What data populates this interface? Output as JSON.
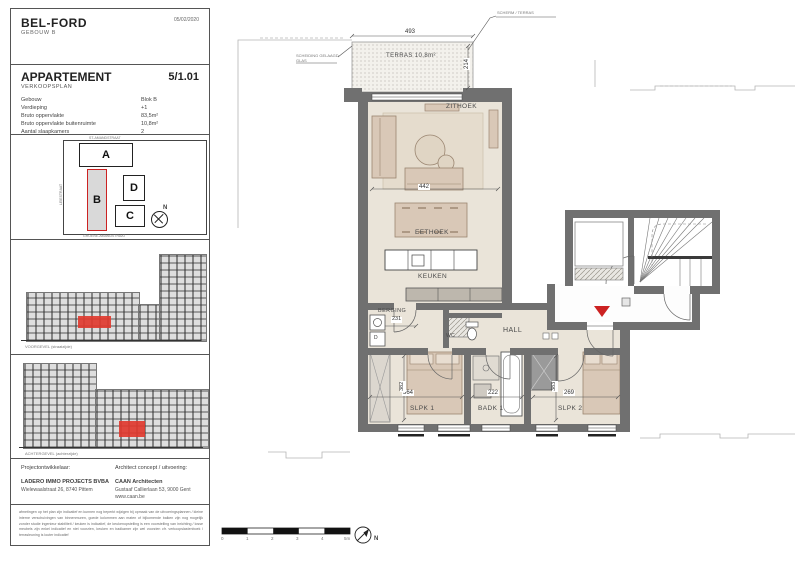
{
  "header": {
    "title": "BEL-FORD",
    "subtitle": "GEBOUW B",
    "date": "05/02/2020"
  },
  "apartment": {
    "label": "APPARTEMENT",
    "number": "5/1.01",
    "plan_type": "VERKOOPSPLAN",
    "specs": [
      {
        "label": "Gebouw",
        "value": "Blok B"
      },
      {
        "label": "Verdieping",
        "value": "+1"
      },
      {
        "label": "Bruto oppervlakte",
        "value": "83,5m²"
      },
      {
        "label": "Bruto oppervlakte buitenruimte",
        "value": "10,8m²"
      },
      {
        "label": "Aantal slaapkamers",
        "value": "2"
      },
      {
        "label": "plafondhoogte",
        "value": "+/-2,50m"
      }
    ]
  },
  "siteplan": {
    "blocks": [
      "A",
      "B",
      "C",
      "D"
    ],
    "street_top": "ST-AMANDSTRAAT",
    "street_left": "LEIESTRAAT",
    "street_bottom": "GROENE-AMANDSTRAAT",
    "north_label": "N"
  },
  "elevations": [
    {
      "caption": "VOORGEVEL (straatzijde)"
    },
    {
      "caption": "ACHTERGEVEL (achterzijde)"
    }
  ],
  "project": {
    "developer_label": "Projectontwikkelaar:",
    "developer_name": "LADERO IMMO PROJECTS BVBA",
    "developer_address": "Wielewaalstraat 26, 8740 Pittem",
    "architect_label": "Architect concept / uitvoering:",
    "architect_name": "CAAN Architecten",
    "architect_address": "Gustaaf Callierlaan 53, 9000 Gent",
    "architect_web": "www.caan.be"
  },
  "disclaimer": "afmetingen op het plan zijn indicatief en kunnen nog beperkt wijzigen bij opmaak van de uitvoeringsplannen / kleine interne verschuivingen van binnenmuren, goede kolommen aan maten of bijkomende balken zijn nog mogelijk zonder studie ingenieur stabiliteit / keuken is indicatief, de keukenopstelling is een voorstelling van inrichting / losse meubels zijn enkel indicatief en niet voorzien, keuken en badkamer zijn wel voorzien cfr. verkoopslastenboek / terrasleuning is louter indicatief",
  "plan": {
    "rooms": {
      "terras": "TERRAS 10,8m²",
      "zithoek": "ZITHOEK",
      "eethoek": "EETHOEK",
      "keuken": "KEUKEN",
      "berging": "BERGING",
      "wc": "WC",
      "hall": "HALL",
      "slpk1": "SLPK 1",
      "badk1": "BADK 1",
      "slpk2": "SLPK 2"
    },
    "dims": {
      "terras_w": "493",
      "terras_d": "214",
      "living_w": "442",
      "berging_w": "231",
      "slpk1_w": "364",
      "slpk1_d": "382",
      "badk1_w": "222",
      "slpk2_w": "269",
      "slpk2_d": "383"
    },
    "dryer_label": "D",
    "notes": {
      "top": "SCHERM / TERRAS",
      "left1": "SCHEIDING GELAAGD",
      "left2": "GLAS"
    },
    "scale": {
      "ticks": [
        "0",
        "1",
        "2",
        "3",
        "4",
        "5m"
      ]
    },
    "north_label": "N",
    "colors": {
      "wall": "#707070",
      "floor": "#eae4d9",
      "furniture": "#d9c8b7",
      "accent_red": "#cc2222"
    }
  }
}
